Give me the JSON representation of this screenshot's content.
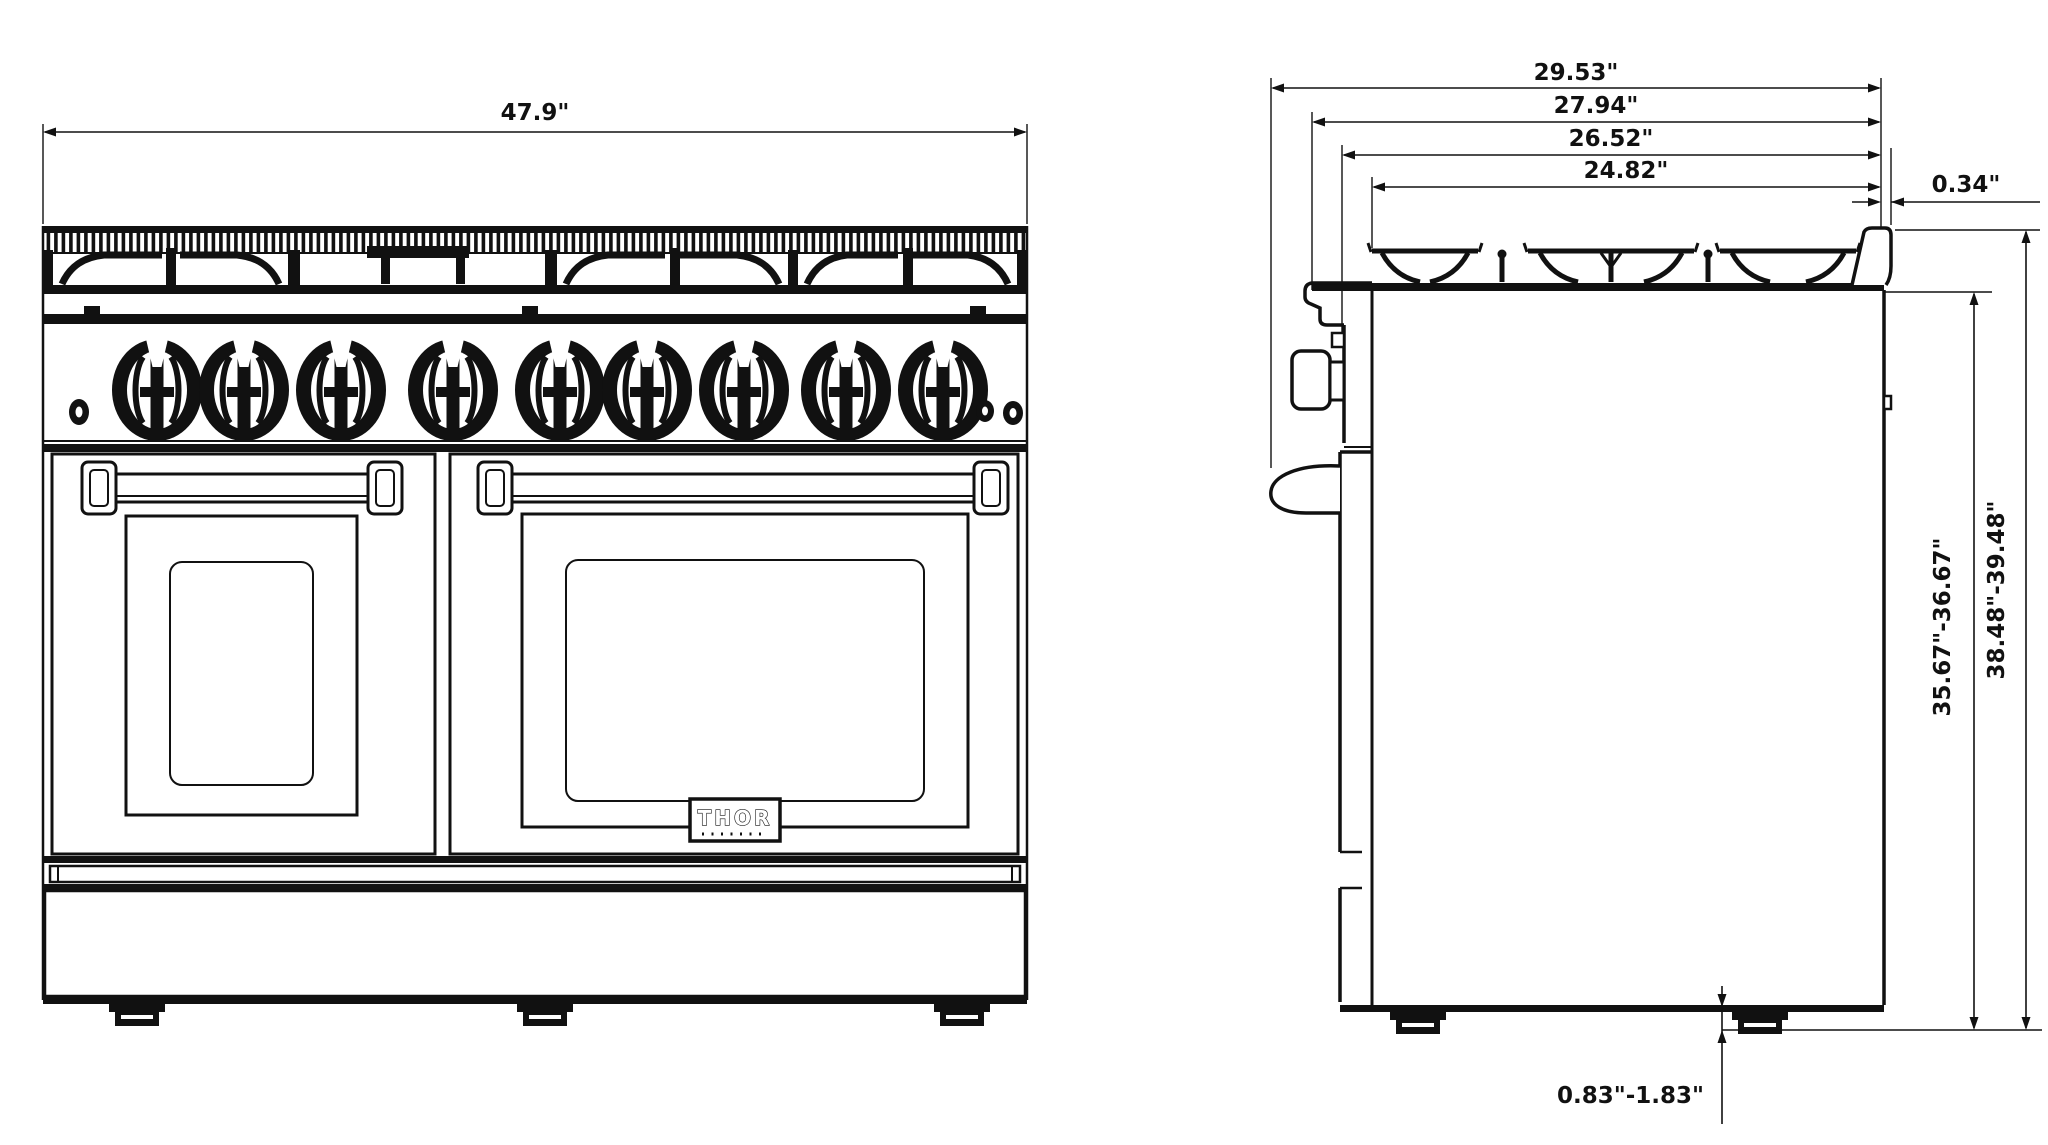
{
  "front_view": {
    "width_dim": "47.9\"",
    "brand_logo": "THOR"
  },
  "side_view": {
    "depth_dims": [
      "29.53\"",
      "27.94\"",
      "26.52\"",
      "24.82\""
    ],
    "back_lip_offset_dim": "0.34\"",
    "height_to_cooktop_dim": "35.67\"-36.67\"",
    "overall_height_dim": "38.48\"-39.48\"",
    "leg_height_dim": "0.83\"-1.83\""
  },
  "colors": {
    "line": "#111111",
    "background": "#ffffff"
  }
}
